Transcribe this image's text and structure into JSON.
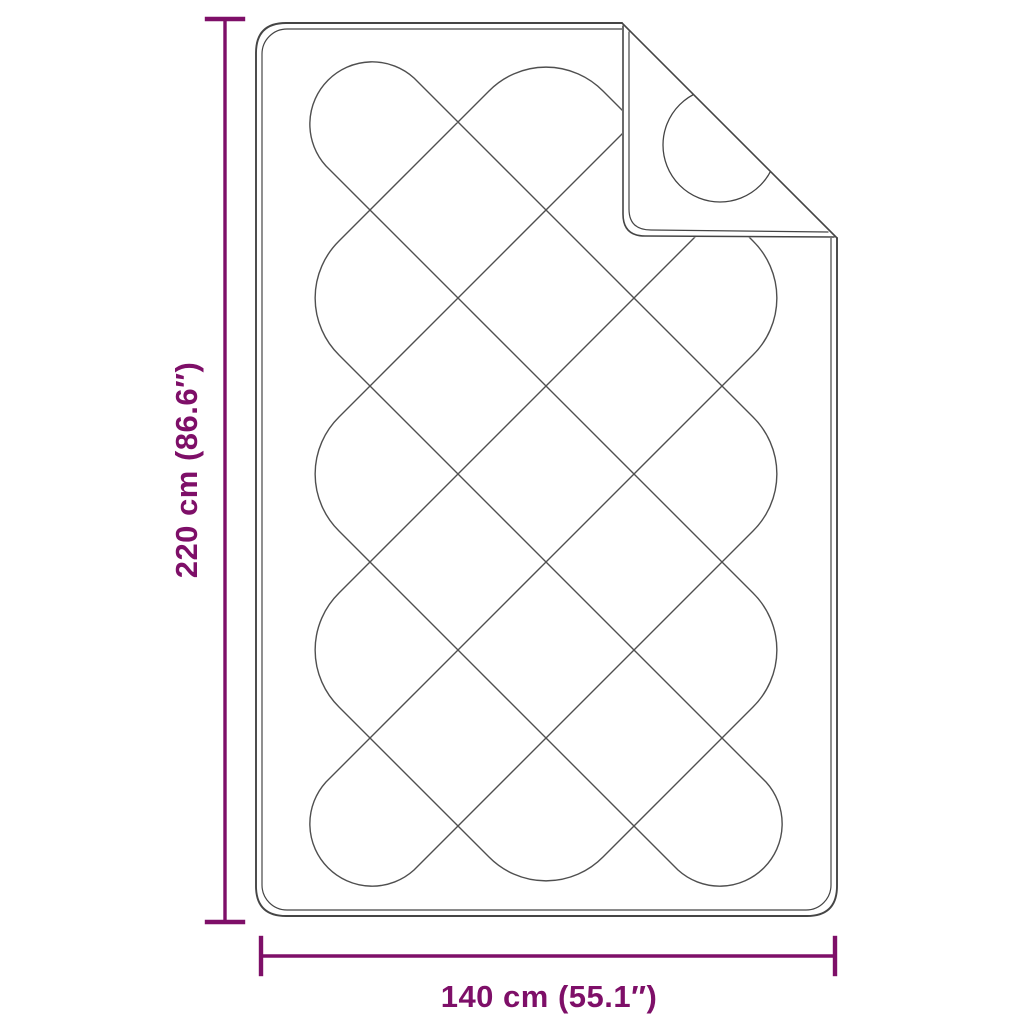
{
  "diagram": {
    "type": "product dimension diagram",
    "subject": "quilted blanket with folded top-right corner",
    "height_dimension_label": "220 cm (86.6″)",
    "width_dimension_label": "140 cm (55.1″)"
  },
  "colors": {
    "dimension_accent": "#7e0f68",
    "outline_gray": "#454545",
    "pattern_gray": "#4f4f4f",
    "background": "#ffffff"
  }
}
